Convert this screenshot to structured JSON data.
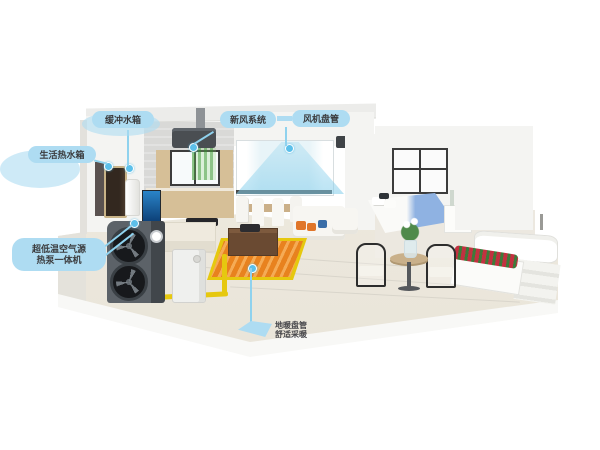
{
  "callouts": {
    "buffer_tank": {
      "text": "缓冲水箱"
    },
    "hot_water_tank": {
      "text": "生活热水箱"
    },
    "fresh_air_unit": {
      "text": "新风系统"
    },
    "fan_coil": {
      "text": "风机盘管"
    },
    "heat_pump": {
      "line1": "超低温空气源",
      "line2": "热泵一体机"
    },
    "floor_heating": {
      "line1": "地暖盘管",
      "line2": "舒适采暖"
    }
  },
  "colors": {
    "callout_bubble": "#aedcf2",
    "callout_text": "#3a3a3c",
    "marker_dot": "#5cc0ea",
    "floor_heating_orange": "#e8821e",
    "floor_heating_stripe": "#f5ab55",
    "pipe_yellow": "#e6c80f",
    "outdoor_unit_gray": "#585e64",
    "airflow_cyan": "#82cdeb",
    "fresh_air_green": "#50aa46",
    "blanket_blue": "#8fb2e2",
    "flower_red": "#c23140"
  }
}
